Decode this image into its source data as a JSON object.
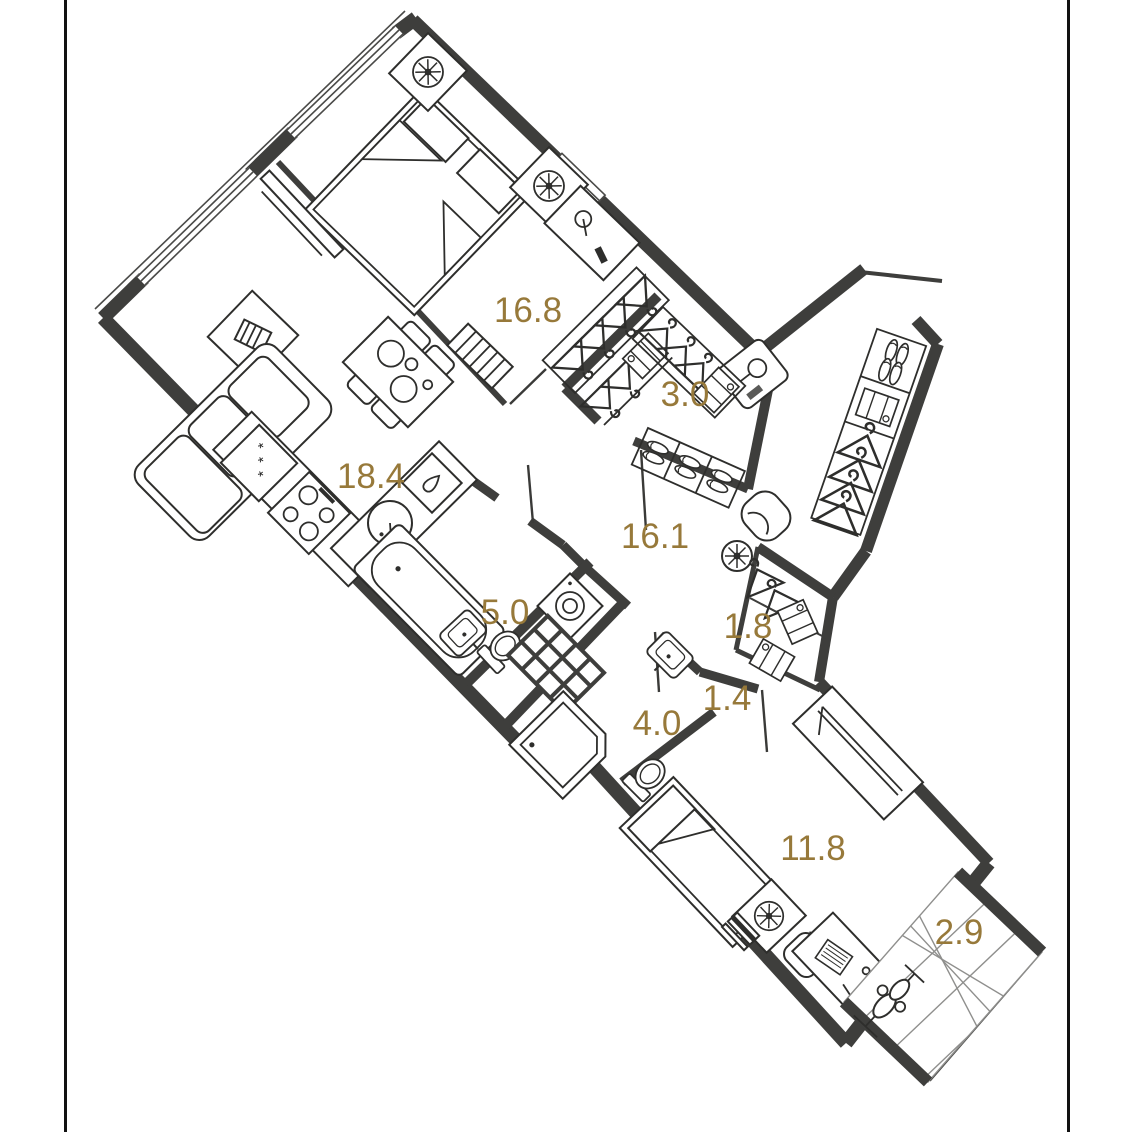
{
  "plan": {
    "type": "apartment-floor-plan",
    "wall_color": "#3e3e3c",
    "label_color": "#97793a",
    "frame_color": "#111111",
    "rooms": [
      {
        "id": "bedroom-main",
        "area": "16.8"
      },
      {
        "id": "living-kitchen",
        "area": "18.4"
      },
      {
        "id": "wardrobe",
        "area": "3.0"
      },
      {
        "id": "hallway",
        "area": "16.1"
      },
      {
        "id": "bathroom",
        "area": "5.0"
      },
      {
        "id": "closet",
        "area": "1.8"
      },
      {
        "id": "corridor",
        "area": "1.4"
      },
      {
        "id": "shower-room",
        "area": "4.0"
      },
      {
        "id": "bedroom-second",
        "area": "11.8"
      },
      {
        "id": "balcony",
        "area": "2.9"
      }
    ]
  }
}
